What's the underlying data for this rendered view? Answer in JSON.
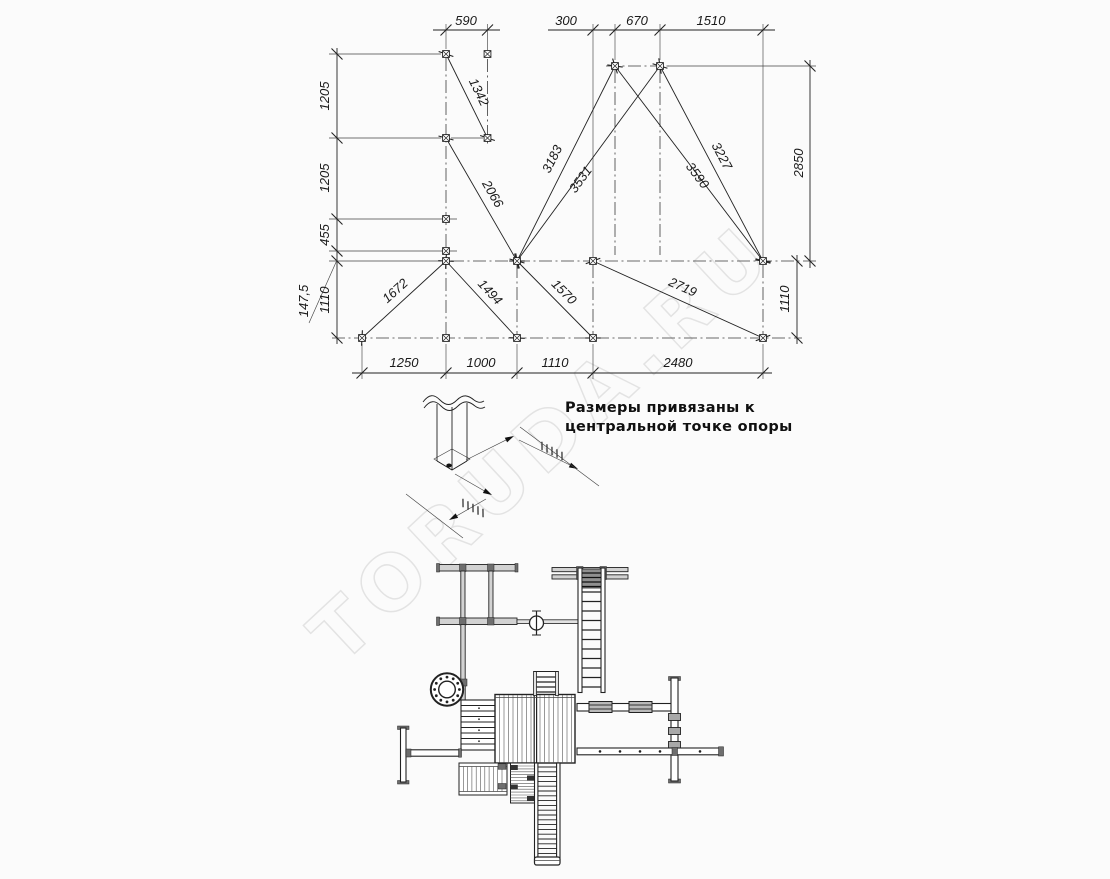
{
  "watermark": {
    "text": "TORUDA.RU"
  },
  "note": {
    "line1": "Размеры привязаны к",
    "line2": "центральной точке опоры"
  },
  "dims": {
    "top_590": "590",
    "top_300": "300",
    "top_670": "670",
    "top_1510": "1510",
    "left_1205_upper": "1205",
    "left_1205_lower": "1205",
    "left_455": "455",
    "left_147_5": "147,5",
    "left_1110": "1110",
    "right_2850": "2850",
    "right_1110": "1110",
    "bottom_1250": "1250",
    "bottom_1000": "1000",
    "bottom_1110": "1110",
    "bottom_2480": "2480",
    "diag_1342": "1342",
    "diag_2066": "2066",
    "diag_3183": "3183",
    "diag_3531": "3531",
    "diag_3590": "3590",
    "diag_3227": "3227",
    "diag_1672": "1672",
    "diag_1494": "1494",
    "diag_1570": "1570",
    "diag_2719": "2719"
  },
  "colors": {
    "line": "#222222",
    "centerline": "#3a3a3a",
    "beam_fill": "#d2d2d2",
    "watermark": "#dedede",
    "background": "#fbfbfb"
  }
}
